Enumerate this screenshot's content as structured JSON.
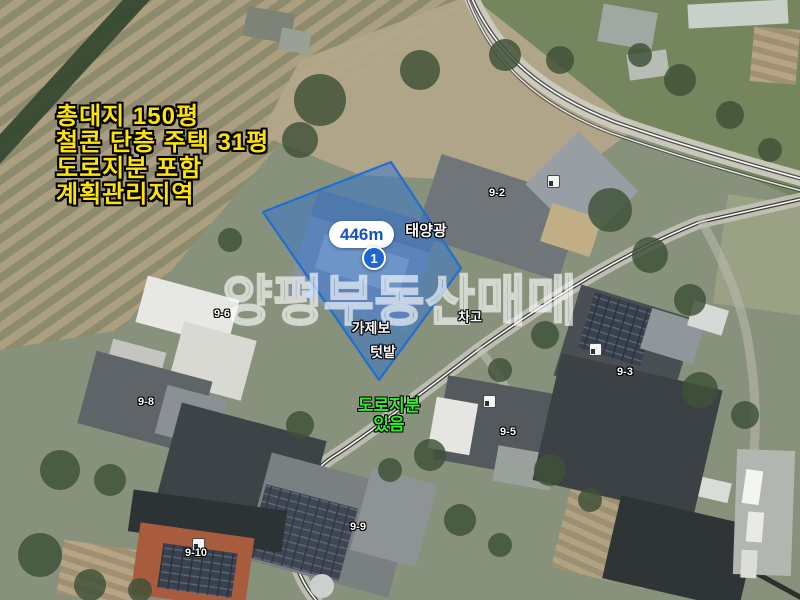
{
  "map": {
    "info_block": {
      "lines": [
        "총대지 150평",
        "철콘 단층 주택 31평",
        "도로지분 포함",
        "계획관리지역"
      ],
      "text_color": "#ffe400"
    },
    "watermark": {
      "text": "양평부동산매매"
    },
    "measurement": {
      "distance": "446m",
      "marker": "1"
    },
    "road_note": {
      "line1": "도로지분",
      "line2": "있음",
      "text_color": "#2ef22e"
    },
    "place_labels": {
      "solar": "태양광",
      "gazebo": "가제보",
      "garden": "텃밭",
      "garage": "차고"
    },
    "parcel_labels": [
      "9-2",
      "9-6",
      "9-8",
      "9-3",
      "9-5",
      "9-9",
      "9-10"
    ],
    "icons": {
      "building_poi": "building-icon"
    },
    "colors": {
      "parcel_fill": "#2874d9",
      "parcel_stroke": "#1f6fd2",
      "pill_text": "#1450c0",
      "marker_bg": "#1b66d2"
    }
  }
}
